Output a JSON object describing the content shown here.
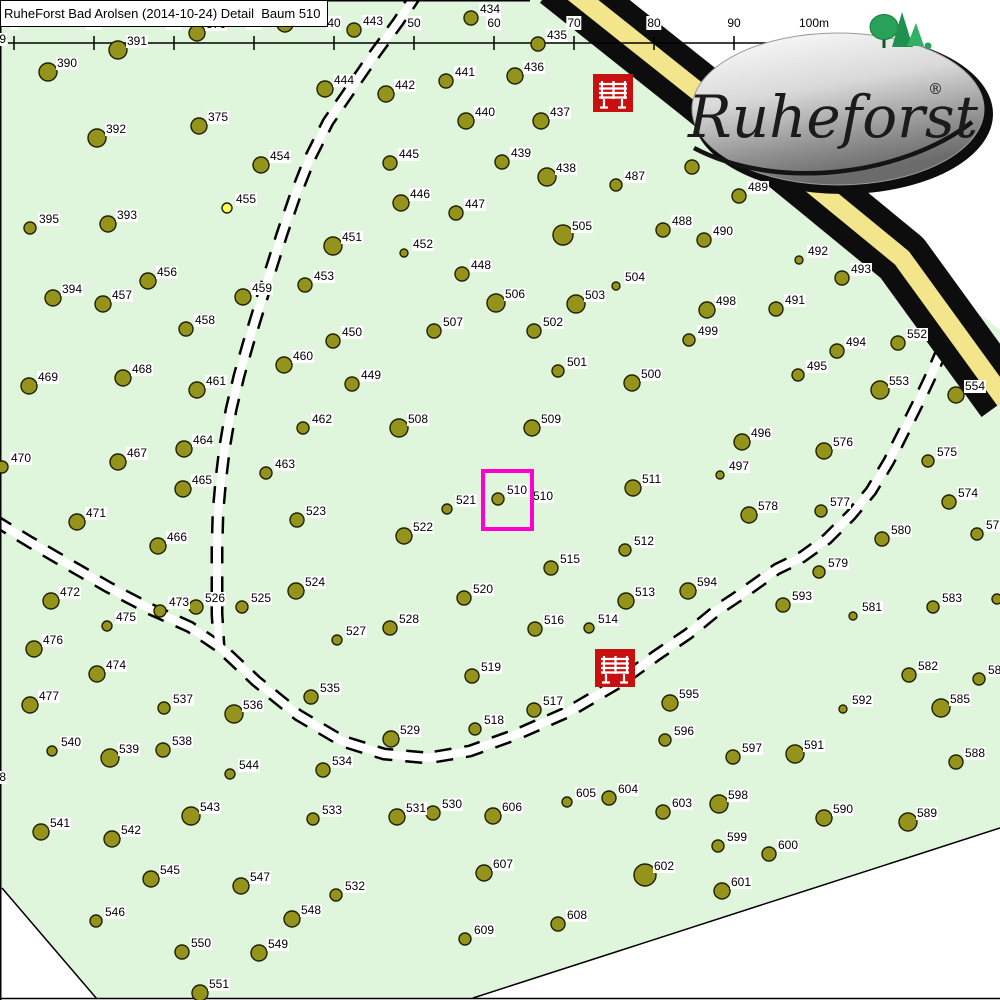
{
  "title": "RuheForst Bad Arolsen (2014-10-24) Detail  Baum 510",
  "colors": {
    "forest_green": "#E0F6DC",
    "tree_olive": "#94941C",
    "road_yellow": "#F2E58C",
    "bench_red": "#C81010",
    "selection_magenta": "#FF00CF",
    "highlight_yellow": "#FFFF55"
  },
  "logo": {
    "text": "Ruheforst",
    "registered": "®"
  },
  "scale": {
    "x0": 14,
    "step": 80,
    "line_y": 43,
    "labels": [
      "0",
      "10",
      "20",
      "30",
      "40",
      "50",
      "60",
      "70",
      "80",
      "90",
      "100m"
    ]
  },
  "selection": {
    "tree": "510",
    "x": 481,
    "y": 469,
    "width": 53,
    "height": 62
  },
  "benches": [
    {
      "x": 593,
      "y": 74
    },
    {
      "x": 595,
      "y": 649
    }
  ],
  "trees": [
    [
      "389",
      -12,
      48,
      6,
      -15,
      33
    ],
    [
      "390",
      48,
      72,
      9
    ],
    [
      "391",
      118,
      50,
      9
    ],
    [
      "376",
      197,
      33,
      8
    ],
    [
      "374",
      285,
      24,
      8
    ],
    [
      "443",
      354,
      30,
      7
    ],
    [
      "434",
      471,
      18,
      7
    ],
    [
      "435",
      538,
      44,
      7
    ],
    [
      "444",
      325,
      89,
      8
    ],
    [
      "442",
      386,
      94,
      8
    ],
    [
      "441",
      446,
      81,
      7
    ],
    [
      "436",
      515,
      76,
      8
    ],
    [
      "440",
      466,
      121,
      8
    ],
    [
      "437",
      541,
      121,
      8
    ],
    [
      "375",
      199,
      126,
      8
    ],
    [
      "392",
      97,
      138,
      9
    ],
    [
      "454",
      261,
      165,
      8
    ],
    [
      "445",
      390,
      163,
      7
    ],
    [
      "439",
      502,
      162,
      7
    ],
    [
      "438",
      547,
      177,
      9
    ],
    [
      "487",
      616,
      185,
      6
    ],
    [
      "446",
      401,
      203,
      8
    ],
    [
      "447",
      456,
      213,
      7
    ],
    [
      "455",
      227,
      208,
      5,
      null,
      null,
      "hl"
    ],
    [
      "393",
      108,
      224,
      8
    ],
    [
      "395",
      30,
      228,
      6
    ],
    [
      "505",
      563,
      235,
      10
    ],
    [
      "451",
      333,
      246,
      9
    ],
    [
      "452",
      404,
      253,
      4
    ],
    [
      "456",
      148,
      281,
      8
    ],
    [
      "448",
      462,
      274,
      7
    ],
    [
      "453",
      305,
      285,
      7
    ],
    [
      "504",
      616,
      286,
      4
    ],
    [
      "459",
      243,
      297,
      8
    ],
    [
      "394",
      53,
      298,
      8
    ],
    [
      "457",
      103,
      304,
      8
    ],
    [
      "506",
      496,
      303,
      9
    ],
    [
      "503",
      576,
      304,
      9
    ],
    [
      "",
      692,
      167,
      7
    ],
    [
      "489",
      739,
      196,
      7
    ],
    [
      "488",
      663,
      230,
      7
    ],
    [
      "490",
      704,
      240,
      7
    ],
    [
      "492",
      799,
      260,
      4
    ],
    [
      "493",
      842,
      278,
      7
    ],
    [
      "458",
      186,
      329,
      7
    ],
    [
      "507",
      434,
      331,
      7
    ],
    [
      "502",
      534,
      331,
      7
    ],
    [
      "498",
      707,
      310,
      8
    ],
    [
      "491",
      776,
      309,
      7
    ],
    [
      "499",
      689,
      340,
      6
    ],
    [
      "552",
      898,
      343,
      7
    ],
    [
      "494",
      837,
      351,
      7
    ],
    [
      "495",
      798,
      375,
      6
    ],
    [
      "553",
      880,
      390,
      9
    ],
    [
      "554",
      956,
      395,
      8
    ],
    [
      "450",
      333,
      341,
      7
    ],
    [
      "449",
      352,
      384,
      7
    ],
    [
      "460",
      284,
      365,
      8
    ],
    [
      "461",
      197,
      390,
      8
    ],
    [
      "468",
      123,
      378,
      8
    ],
    [
      "469",
      29,
      386,
      8
    ],
    [
      "501",
      558,
      371,
      6
    ],
    [
      "500",
      632,
      383,
      8
    ],
    [
      "462",
      303,
      428,
      6
    ],
    [
      "464",
      184,
      449,
      8
    ],
    [
      "467",
      118,
      462,
      8
    ],
    [
      "470",
      2,
      467,
      6
    ],
    [
      "508",
      399,
      428,
      9
    ],
    [
      "509",
      532,
      428,
      8
    ],
    [
      "463",
      266,
      473,
      6
    ],
    [
      "465",
      183,
      489,
      8
    ],
    [
      "471",
      77,
      522,
      8
    ],
    [
      "523",
      297,
      520,
      7
    ],
    [
      "466",
      158,
      546,
      8
    ],
    [
      "496",
      742,
      442,
      8
    ],
    [
      "576",
      824,
      451,
      8
    ],
    [
      "575",
      928,
      461,
      6
    ],
    [
      "497",
      720,
      475,
      4
    ],
    [
      "574",
      949,
      502,
      7
    ],
    [
      "578",
      749,
      515,
      8
    ],
    [
      "577",
      821,
      511,
      6
    ],
    [
      "572",
      977,
      534,
      6
    ],
    [
      "580",
      882,
      539,
      7
    ],
    [
      "579",
      819,
      572,
      6
    ],
    [
      "594",
      688,
      591,
      8
    ],
    [
      "593",
      783,
      605,
      7
    ],
    [
      "581",
      853,
      616,
      4
    ],
    [
      "583",
      933,
      607,
      6
    ],
    [
      "",
      997,
      599,
      5
    ],
    [
      "510",
      498,
      499,
      6
    ],
    [
      "510",
      0,
      0,
      0,
      532,
      490
    ],
    [
      "521",
      447,
      509,
      5
    ],
    [
      "522",
      404,
      536,
      8
    ],
    [
      "511",
      633,
      488,
      8
    ],
    [
      "512",
      625,
      550,
      6
    ],
    [
      "515",
      551,
      568,
      7
    ],
    [
      "520",
      464,
      598,
      7
    ],
    [
      "513",
      626,
      601,
      8
    ],
    [
      "516",
      535,
      629,
      7
    ],
    [
      "514",
      589,
      628,
      5
    ],
    [
      "528",
      390,
      628,
      7
    ],
    [
      "527",
      337,
      640,
      5
    ],
    [
      "524",
      296,
      591,
      8
    ],
    [
      "525",
      242,
      607,
      6
    ],
    [
      "526",
      196,
      607,
      7
    ],
    [
      "473",
      160,
      611,
      6
    ],
    [
      "472",
      51,
      601,
      8
    ],
    [
      "475",
      107,
      626,
      5
    ],
    [
      "476",
      34,
      649,
      8
    ],
    [
      "474",
      97,
      674,
      8
    ],
    [
      "477",
      30,
      705,
      8
    ],
    [
      "537",
      164,
      708,
      6
    ],
    [
      "536",
      234,
      714,
      9
    ],
    [
      "535",
      311,
      697,
      7
    ],
    [
      "519",
      472,
      676,
      7
    ],
    [
      "517",
      534,
      710,
      7
    ],
    [
      "518",
      475,
      729,
      6
    ],
    [
      "540",
      52,
      751,
      5
    ],
    [
      "539",
      110,
      758,
      9
    ],
    [
      "538",
      163,
      750,
      7
    ],
    [
      "529",
      391,
      739,
      8
    ],
    [
      "534",
      323,
      770,
      7
    ],
    [
      "544",
      230,
      774,
      5
    ],
    [
      "543",
      191,
      816,
      9
    ],
    [
      "533",
      313,
      819,
      6
    ],
    [
      "531",
      397,
      817,
      8
    ],
    [
      "530",
      433,
      813,
      7
    ],
    [
      "606",
      493,
      816,
      8
    ],
    [
      "605",
      567,
      802,
      5
    ],
    [
      "604",
      609,
      798,
      7
    ],
    [
      "603",
      663,
      812,
      7
    ],
    [
      "595",
      670,
      703,
      8
    ],
    [
      "596",
      665,
      740,
      6
    ],
    [
      "582",
      909,
      675,
      7
    ],
    [
      "584",
      979,
      679,
      6
    ],
    [
      "585",
      941,
      708,
      9
    ],
    [
      "592",
      843,
      709,
      4
    ],
    [
      "588",
      956,
      762,
      7
    ],
    [
      "597",
      733,
      757,
      7
    ],
    [
      "591",
      795,
      754,
      9
    ],
    [
      "598",
      719,
      804,
      9
    ],
    [
      "590",
      824,
      818,
      8
    ],
    [
      "589",
      908,
      822,
      9
    ],
    [
      "599",
      718,
      846,
      6
    ],
    [
      "600",
      769,
      854,
      7
    ],
    [
      "602",
      645,
      875,
      11
    ],
    [
      "601",
      722,
      891,
      8
    ],
    [
      "607",
      484,
      873,
      8
    ],
    [
      "608",
      558,
      924,
      7
    ],
    [
      "609",
      465,
      939,
      6
    ],
    [
      "541",
      41,
      832,
      8
    ],
    [
      "542",
      112,
      839,
      8
    ],
    [
      "545",
      151,
      879,
      8
    ],
    [
      "546",
      96,
      921,
      6
    ],
    [
      "547",
      241,
      886,
      8
    ],
    [
      "548",
      292,
      919,
      8
    ],
    [
      "532",
      336,
      895,
      6
    ],
    [
      "550",
      182,
      952,
      7
    ],
    [
      "549",
      259,
      953,
      8
    ],
    [
      "551",
      200,
      993,
      8
    ],
    [
      "478",
      -8,
      788,
      6,
      -15,
      771
    ]
  ]
}
